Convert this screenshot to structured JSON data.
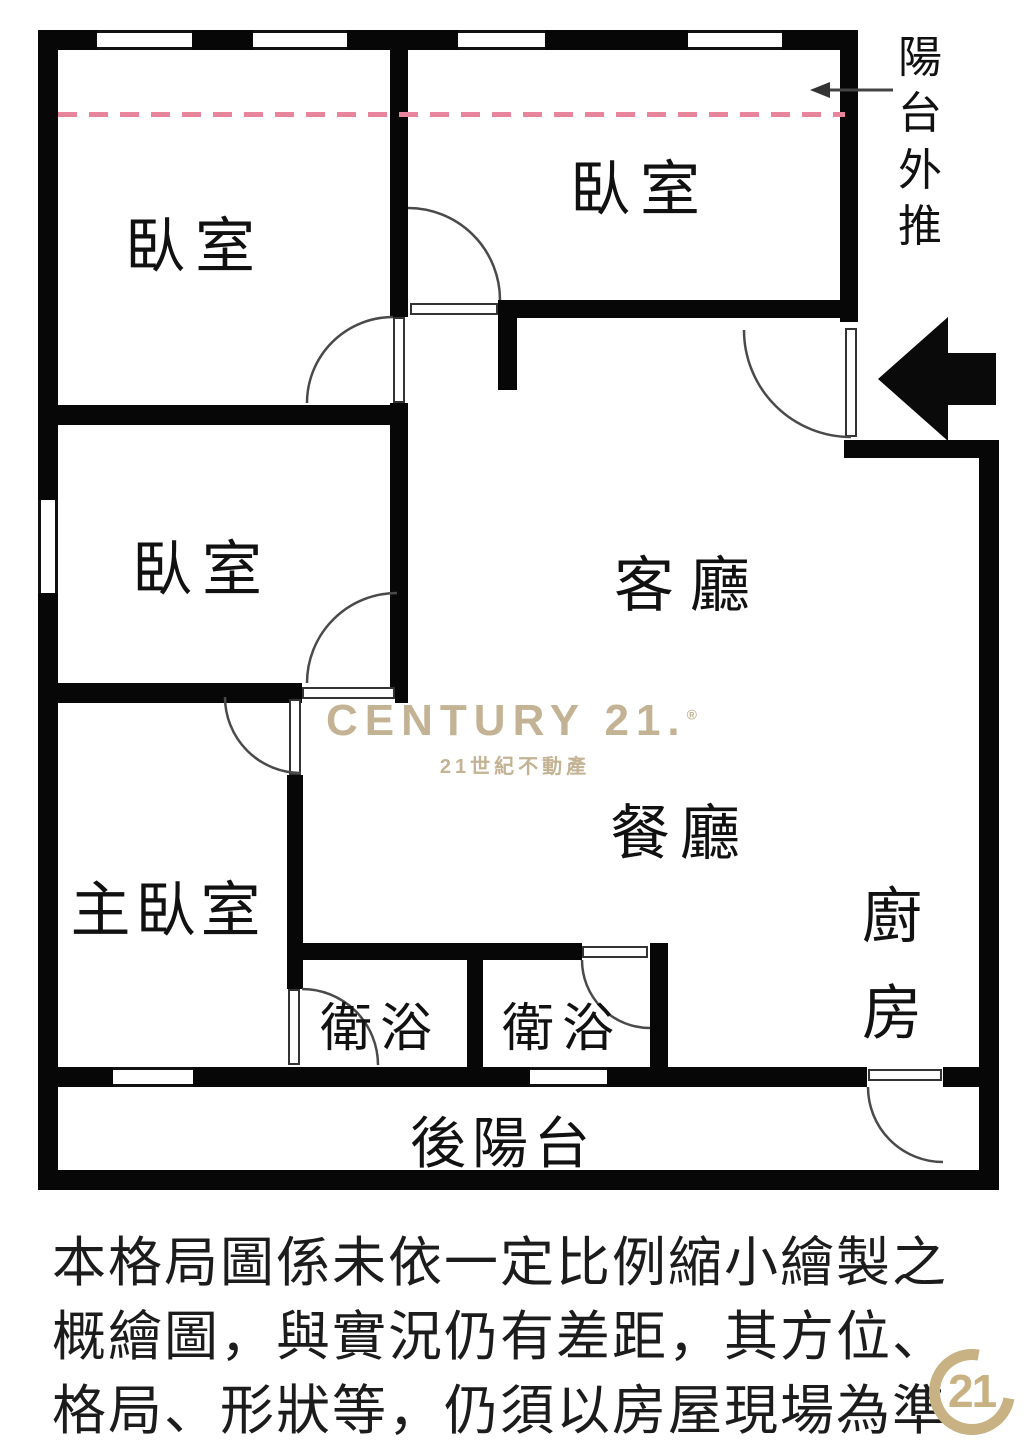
{
  "page": {
    "background": "#ffffff",
    "width": 1024,
    "height": 1448
  },
  "floor_plan": {
    "rooms": {
      "bedroom_top_left": "臥室",
      "bedroom_top_right": "臥室",
      "bedroom_middle": "臥室",
      "master_bedroom": "主臥室",
      "living_room": "客廳",
      "dining_room": "餐廳",
      "kitchen": "廚房",
      "bathroom_left": "衛浴",
      "bathroom_right": "衛浴",
      "back_balcony": "後陽台"
    },
    "annotations": {
      "balcony_pushout": "陽台外推"
    },
    "colors": {
      "wall": "#070707",
      "pushout_dashed_line": "#e8849b"
    }
  },
  "watermark": {
    "brand": "CENTURY 21.",
    "registered_mark": "®",
    "subtitle": "21世紀不動產",
    "color": "#c3b394"
  },
  "corner_seal": {
    "label": "21",
    "color": "#c8b182"
  },
  "disclaimer": {
    "line1": "本格局圖係未依一定比例縮小繪製之",
    "line2": "概繪圖，與實況仍有差距，其方位、",
    "line3": "格局、形狀等，仍須以房屋現場為準"
  }
}
